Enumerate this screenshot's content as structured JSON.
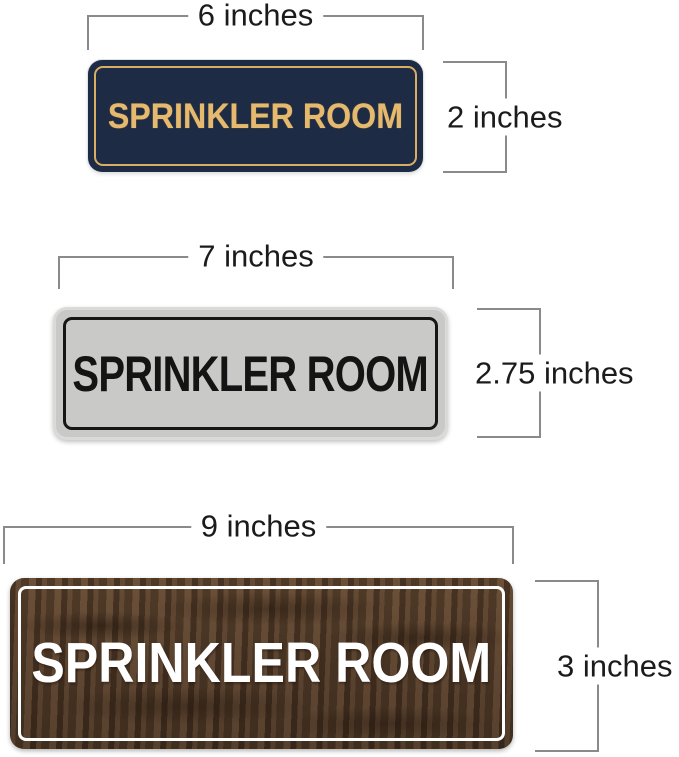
{
  "page": {
    "background": "#ffffff"
  },
  "annotation": {
    "line_color": "#8a8a8a",
    "text_color": "#1b1b1b"
  },
  "signs": [
    {
      "name": "navy-gold-sign",
      "text": "SPRINKLER ROOM",
      "width_label": "6 inches",
      "height_label": "2 inches",
      "colors": {
        "face": "#1d2b45",
        "text": "#e6ba6e",
        "border_line": "#d9ad62"
      }
    },
    {
      "name": "silver-black-sign",
      "text": "SPRINKLER ROOM",
      "width_label": "7 inches",
      "height_label": "2.75 inches",
      "colors": {
        "face": "#c9c9c7",
        "text": "#141414",
        "border_line": "#161616"
      }
    },
    {
      "name": "walnut-wood-sign",
      "text": "SPRINKLER ROOM",
      "width_label": "9 inches",
      "height_label": "3 inches",
      "colors": {
        "face": "#5a4330",
        "text": "#ffffff",
        "border_line": "#ffffff"
      }
    }
  ]
}
